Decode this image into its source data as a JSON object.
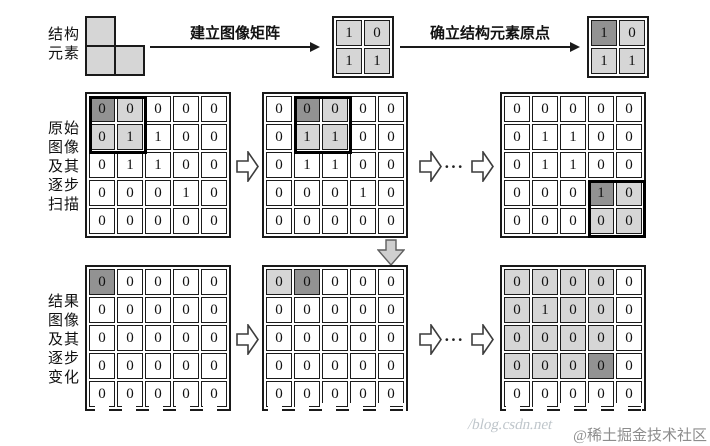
{
  "colors": {
    "cell_light": "#d6d6d6",
    "cell_dark": "#929292",
    "line": "#1a1a1a"
  },
  "top_row": {
    "label_lines": [
      "结构",
      "元素"
    ],
    "arrow1_label": "建立图像矩阵",
    "arrow2_label": "确立结构元素原点",
    "kernel": {
      "values": [
        [
          1,
          0
        ],
        [
          1,
          1
        ]
      ],
      "light": [
        [
          0,
          0
        ],
        [
          0,
          1
        ],
        [
          1,
          0
        ],
        [
          1,
          1
        ]
      ],
      "dark": []
    },
    "kernel_with_origin": {
      "values": [
        [
          1,
          0
        ],
        [
          1,
          1
        ]
      ],
      "light": [
        [
          0,
          1
        ],
        [
          1,
          0
        ],
        [
          1,
          1
        ]
      ],
      "dark": [
        [
          0,
          0
        ]
      ]
    }
  },
  "middle_row": {
    "label_lines": [
      "原始",
      "图像",
      "及其",
      "逐步",
      "扫描"
    ],
    "ellipsis": "···",
    "matrices": [
      {
        "values": [
          [
            0,
            0,
            0,
            0,
            0
          ],
          [
            0,
            1,
            1,
            0,
            0
          ],
          [
            0,
            1,
            1,
            0,
            0
          ],
          [
            0,
            0,
            0,
            1,
            0
          ],
          [
            0,
            0,
            0,
            0,
            0
          ]
        ],
        "dark": [
          [
            0,
            0
          ]
        ],
        "light": [
          [
            0,
            1
          ],
          [
            1,
            0
          ],
          [
            1,
            1
          ]
        ],
        "block": [
          0,
          0
        ]
      },
      {
        "values": [
          [
            0,
            0,
            0,
            0,
            0
          ],
          [
            0,
            1,
            1,
            0,
            0
          ],
          [
            0,
            1,
            1,
            0,
            0
          ],
          [
            0,
            0,
            0,
            1,
            0
          ],
          [
            0,
            0,
            0,
            0,
            0
          ]
        ],
        "dark": [
          [
            0,
            1
          ]
        ],
        "light": [
          [
            0,
            2
          ],
          [
            1,
            1
          ],
          [
            1,
            2
          ]
        ],
        "block": [
          0,
          1
        ]
      },
      {
        "values": [
          [
            0,
            0,
            0,
            0,
            0
          ],
          [
            0,
            1,
            1,
            0,
            0
          ],
          [
            0,
            1,
            1,
            0,
            0
          ],
          [
            0,
            0,
            0,
            1,
            0
          ],
          [
            0,
            0,
            0,
            0,
            0
          ]
        ],
        "dark": [
          [
            3,
            3
          ]
        ],
        "light": [
          [
            3,
            4
          ],
          [
            4,
            3
          ],
          [
            4,
            4
          ]
        ],
        "block": [
          3,
          3
        ]
      }
    ]
  },
  "bottom_row": {
    "label_lines": [
      "结果",
      "图像",
      "及其",
      "逐步",
      "变化"
    ],
    "ellipsis": "···",
    "matrices": [
      {
        "values": [
          [
            0,
            0,
            0,
            0,
            0
          ],
          [
            0,
            0,
            0,
            0,
            0
          ],
          [
            0,
            0,
            0,
            0,
            0
          ],
          [
            0,
            0,
            0,
            0,
            0
          ],
          [
            0,
            0,
            0,
            0,
            0
          ]
        ],
        "dark": [
          [
            0,
            0
          ]
        ],
        "light": [],
        "block": null
      },
      {
        "values": [
          [
            0,
            0,
            0,
            0,
            0
          ],
          [
            0,
            0,
            0,
            0,
            0
          ],
          [
            0,
            0,
            0,
            0,
            0
          ],
          [
            0,
            0,
            0,
            0,
            0
          ],
          [
            0,
            0,
            0,
            0,
            0
          ]
        ],
        "dark": [
          [
            0,
            1
          ]
        ],
        "light": [
          [
            0,
            0
          ]
        ],
        "block": null
      },
      {
        "values": [
          [
            0,
            0,
            0,
            0,
            0
          ],
          [
            0,
            1,
            0,
            0,
            0
          ],
          [
            0,
            0,
            0,
            0,
            0
          ],
          [
            0,
            0,
            0,
            0,
            0
          ],
          [
            0,
            0,
            0,
            0,
            0
          ]
        ],
        "dark": [
          [
            3,
            3
          ]
        ],
        "light": [
          [
            0,
            0
          ],
          [
            0,
            1
          ],
          [
            0,
            2
          ],
          [
            0,
            3
          ],
          [
            1,
            0
          ],
          [
            1,
            1
          ],
          [
            1,
            2
          ],
          [
            1,
            3
          ],
          [
            2,
            0
          ],
          [
            2,
            1
          ],
          [
            2,
            2
          ],
          [
            2,
            3
          ],
          [
            3,
            0
          ],
          [
            3,
            1
          ],
          [
            3,
            2
          ]
        ],
        "block": null
      }
    ]
  },
  "watermark": {
    "url_text": "/blog.csdn.net",
    "credit": "@稀土掘金技术社区"
  }
}
